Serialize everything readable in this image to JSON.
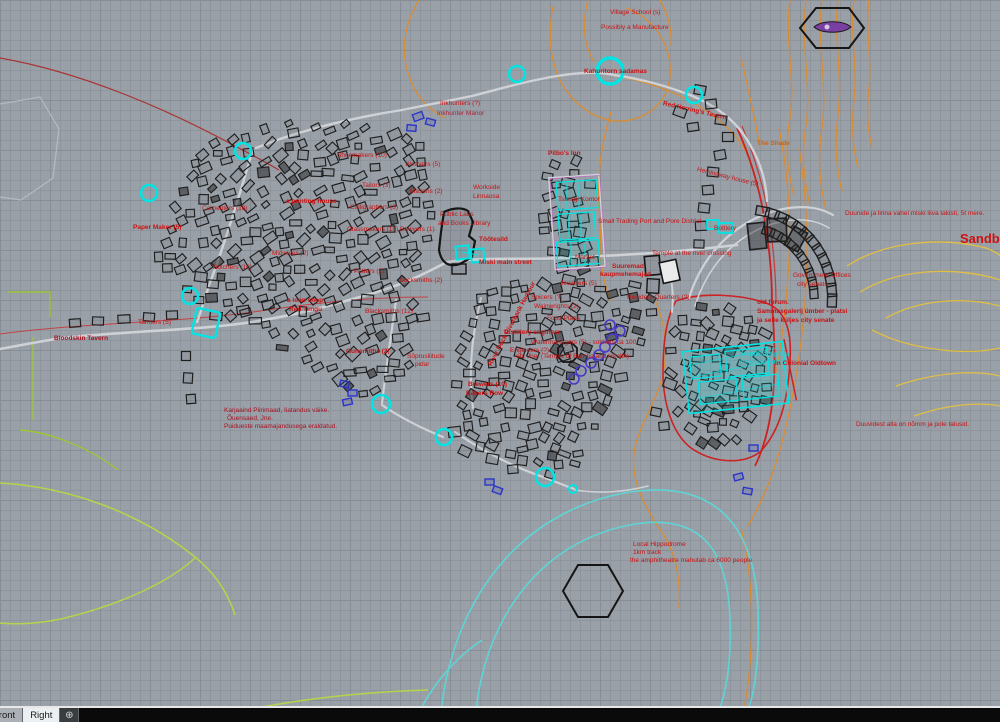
{
  "statusbar": {
    "tabs": [
      "Front",
      "Right"
    ],
    "add_symbol": "⊕"
  },
  "map": {
    "colors": {
      "background": "#9aa0a8",
      "grid_minor": "#8f959d",
      "grid_major": "#878d95",
      "label_red": "#cc1111",
      "label_dark_red": "#aa1122",
      "label_orange": "#d95f00",
      "label_cyan": "#00dcdc",
      "contour_orange": "#e08a28",
      "cliff_red": "#cc2222",
      "marker_cyan": "#00e4e4",
      "road_light": "#ced2d6",
      "field_green": "#b5d44a",
      "annotation_blue": "#2a35c8",
      "ring_purple": "#4838c8"
    },
    "labels": [
      {
        "text": "Village School (s)",
        "x": 610,
        "y": 9
      },
      {
        "text": "Possibly a Manufacture",
        "x": 601,
        "y": 24
      },
      {
        "text": "Kahuritorn sadamas",
        "x": 584,
        "y": 68,
        "bold": true
      },
      {
        "text": "Red Herring's Tavern",
        "x": 663,
        "y": 100,
        "rot": 13,
        "bold": true
      },
      {
        "text": "The Shade",
        "x": 757,
        "y": 140,
        "color": "#d95f00",
        "bold": true
      },
      {
        "text": "Hemingway house (5)",
        "x": 697,
        "y": 166,
        "rot": 14
      },
      {
        "text": "Inkhunters (?)",
        "x": 440,
        "y": 100
      },
      {
        "text": "Inkhunter Manor",
        "x": 437,
        "y": 110,
        "color": "#aa2233"
      },
      {
        "text": "Shoemakers (10)",
        "x": 337,
        "y": 152
      },
      {
        "text": "Weavers (5)",
        "x": 405,
        "y": 161
      },
      {
        "text": "Tailors (3)",
        "x": 362,
        "y": 182
      },
      {
        "text": "Masons (2)",
        "x": 410,
        "y": 188
      },
      {
        "text": "a printing house",
        "x": 286,
        "y": 198,
        "bold": true
      },
      {
        "text": "Calligraphers (3)",
        "x": 350,
        "y": 204
      },
      {
        "text": "Glassmakers (10)",
        "x": 347,
        "y": 226
      },
      {
        "text": "Bowyers (1)",
        "x": 400,
        "y": 226
      },
      {
        "text": "Carpenters (10)",
        "x": 202,
        "y": 205
      },
      {
        "text": "Paper Maker (5)",
        "x": 133,
        "y": 224,
        "bold": true
      },
      {
        "text": "Butchers (10)",
        "x": 213,
        "y": 264
      },
      {
        "text": "Midwives (2)",
        "x": 272,
        "y": 250
      },
      {
        "text": "a loan shop",
        "x": 287,
        "y": 297,
        "bold": true
      },
      {
        "text": "Red Tengu",
        "x": 289,
        "y": 306,
        "bold": true
      },
      {
        "text": "Tanners (5)",
        "x": 138,
        "y": 319
      },
      {
        "text": "Bloodskin Tavern",
        "x": 54,
        "y": 335,
        "bold": true,
        "color": "#aa1122"
      },
      {
        "text": "Potters (2)",
        "x": 354,
        "y": 268
      },
      {
        "text": "Locksmiths (2)",
        "x": 400,
        "y": 277
      },
      {
        "text": "Blacksmiths (12)",
        "x": 365,
        "y": 308
      },
      {
        "text": "Gunsmiths (2)",
        "x": 346,
        "y": 348,
        "bold": true
      },
      {
        "text": "Sõprusliitude",
        "x": 407,
        "y": 353
      },
      {
        "text": "pidar",
        "x": 415,
        "y": 361
      },
      {
        "text": "Workside",
        "x": 473,
        "y": 184
      },
      {
        "text": "Linnaosa",
        "x": 473,
        "y": 193
      },
      {
        "text": "Public Labs",
        "x": 440,
        "y": 211
      },
      {
        "text": "and Books Library",
        "x": 438,
        "y": 220
      },
      {
        "text": "Töötesild",
        "x": 479,
        "y": 236,
        "bold": true
      },
      {
        "text": "Miski main street",
        "x": 479,
        "y": 259,
        "bold": true
      },
      {
        "text": "Pilbo's Inn",
        "x": 548,
        "y": 150,
        "bold": true
      },
      {
        "text": "Tsuragi Kontor",
        "x": 558,
        "y": 196
      },
      {
        "text": "Small Trading Port and Pore District",
        "x": 598,
        "y": 218
      },
      {
        "text": "Market",
        "x": 575,
        "y": 254
      },
      {
        "text": "Suuremad",
        "x": 612,
        "y": 263,
        "bold": true
      },
      {
        "text": "kaupmehemajad",
        "x": 600,
        "y": 271,
        "bold": true
      },
      {
        "text": "Temple at the river crossing",
        "x": 652,
        "y": 250
      },
      {
        "text": "Bottlery",
        "x": 714,
        "y": 225
      },
      {
        "text": "Government Offices",
        "x": 793,
        "y": 272
      },
      {
        "text": "city senate",
        "x": 797,
        "y": 281
      },
      {
        "text": "old forum.",
        "x": 757,
        "y": 299,
        "bold": true
      },
      {
        "text": "Sammasgalerij ümber - platsi",
        "x": 757,
        "y": 308,
        "bold": true
      },
      {
        "text": "ja selle küljes city senate",
        "x": 757,
        "y": 317,
        "bold": true
      },
      {
        "text": "Monument plaza",
        "x": 741,
        "y": 351,
        "color": "#00dcdc"
      },
      {
        "text": "the Great Treat",
        "x": 739,
        "y": 359,
        "color": "#00dcdc"
      },
      {
        "text": "in Colonial Oldtown",
        "x": 775,
        "y": 360,
        "bold": true
      },
      {
        "text": "Jewellers (5)",
        "x": 560,
        "y": 280
      },
      {
        "text": "Spicers (?)",
        "x": 531,
        "y": 294
      },
      {
        "text": "Wainwrights (2)",
        "x": 534,
        "y": 303
      },
      {
        "text": "Resident Quarters (?)",
        "x": 627,
        "y": 294
      },
      {
        "text": "Food Plaza",
        "x": 547,
        "y": 315
      },
      {
        "text": "Distillery engineer",
        "x": 504,
        "y": 329,
        "bold": true
      },
      {
        "text": "Engineers (?)",
        "x": 510,
        "y": 347
      },
      {
        "text": "Watermanagers (5) - soldiers ca 100",
        "x": 531,
        "y": 339
      },
      {
        "text": "ob. Jne. (Temple of Bamba and Health)",
        "x": 516,
        "y": 353
      },
      {
        "text": "River Dock Riverbank Harbour",
        "x": 490,
        "y": 362,
        "rot": -62,
        "bold": true
      },
      {
        "text": "Brewers (10)",
        "x": 468,
        "y": 381,
        "bold": true
      },
      {
        "text": "Bakers Row",
        "x": 466,
        "y": 390,
        "bold": true
      },
      {
        "text": "Duunide ja linna vahel miski liiva takisti, 5t mere.",
        "x": 845,
        "y": 210
      },
      {
        "text": "Sandb",
        "x": 960,
        "y": 232,
        "size": 13,
        "bold": true
      },
      {
        "text": "Duuvidest alla on nõmm ja pole talusid.",
        "x": 856,
        "y": 421
      },
      {
        "text": "Karjaaind Piirimaad, Iiatandus väike.",
        "x": 224,
        "y": 407,
        "color": "#aa1122"
      },
      {
        "text": "Õuensaed, Jne.",
        "x": 227,
        "y": 415,
        "color": "#aa1122"
      },
      {
        "text": "Puidueste maamajandusega eraldatud.",
        "x": 224,
        "y": 423,
        "color": "#aa1122"
      },
      {
        "text": "Local Hippodrome",
        "x": 633,
        "y": 541
      },
      {
        "text": "1km track",
        "x": 633,
        "y": 549
      },
      {
        "text": "the amphitheatre mahutab ca 6000 people",
        "x": 630,
        "y": 557
      }
    ]
  }
}
